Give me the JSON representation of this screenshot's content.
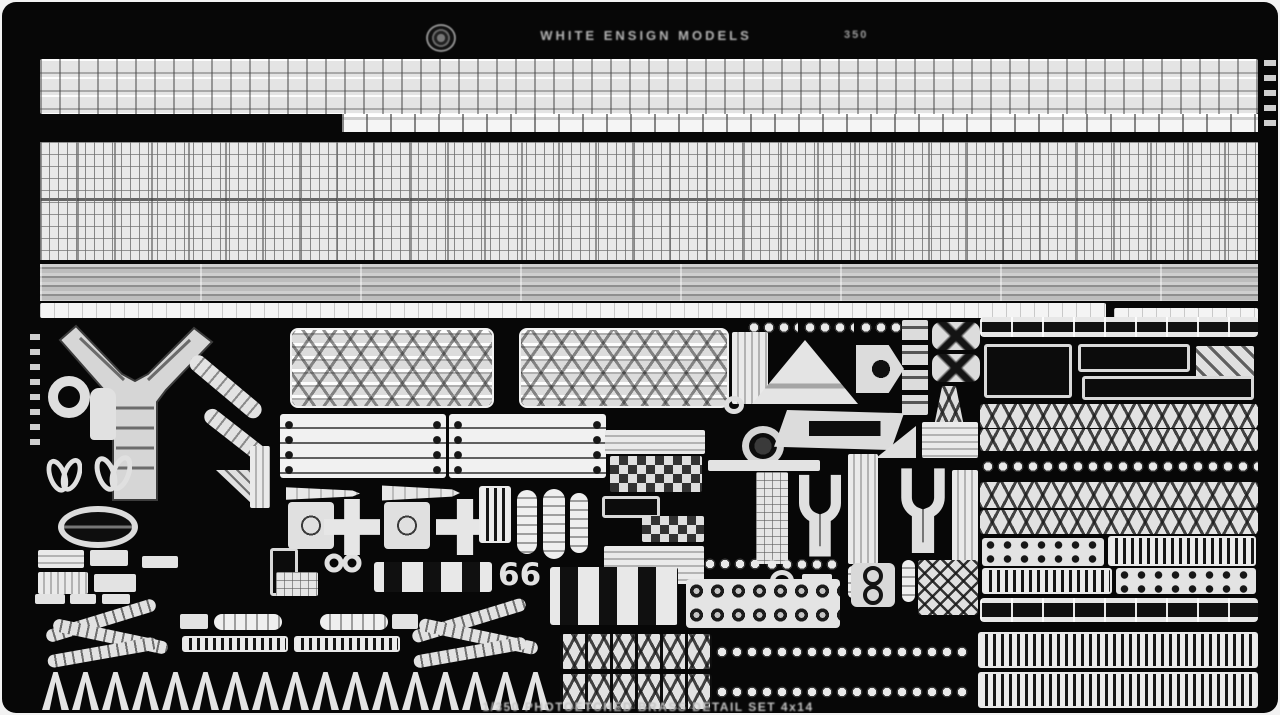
{
  "_legend": "parts fields: n=name, t=visual-type, x/y/w/h=pixel box, r=rotation-deg, c=glyph-text, cnt=repeat-count",
  "header": {
    "brand": "WHITE ENSIGN MODELS",
    "code": "350"
  },
  "footer": {
    "caption": "1/350 PHOTOETCHED BRASS DETAIL SET  4x14"
  },
  "colors": {
    "photo_bg": "#070707",
    "brass_light": "#e4e4e4",
    "brass_mid": "#b9b9b9",
    "brass_dark": "#8a8a8a",
    "caption_text": "#c4c4c4"
  },
  "parts": [
    {
      "n": "railing-stock-band",
      "t": "railing",
      "x": 38,
      "y": 57,
      "w": 1218,
      "h": 55
    },
    {
      "n": "railing-stock-extension",
      "t": "railing-thin",
      "x": 340,
      "y": 112,
      "w": 916,
      "h": 18
    },
    {
      "n": "mesh-grating-panel",
      "t": "mesh",
      "x": 38,
      "y": 140,
      "w": 1218,
      "h": 118
    },
    {
      "n": "inclined-ladder-band",
      "t": "ladders",
      "x": 38,
      "y": 262,
      "w": 1218,
      "h": 37
    },
    {
      "n": "accommodation-ladder-strip",
      "t": "strip-bright",
      "x": 38,
      "y": 301,
      "w": 1066,
      "h": 15
    },
    {
      "n": "accommodation-ladder-strip-right",
      "t": "strip-bright",
      "x": 1112,
      "y": 306,
      "w": 144,
      "h": 14
    },
    {
      "n": "edge-marks-left",
      "t": "edge-marks",
      "x": 28,
      "y": 332,
      "w": 10,
      "h": 120
    },
    {
      "n": "crane-y-frame",
      "t": "yframe",
      "x": 52,
      "y": 322,
      "w": 162,
      "h": 180
    },
    {
      "n": "large-ring",
      "t": "ring",
      "x": 46,
      "y": 374,
      "w": 42,
      "h": 42
    },
    {
      "n": "bottle-part",
      "t": "bottle",
      "x": 88,
      "y": 386,
      "w": 26,
      "h": 52
    },
    {
      "n": "lattice-arm-upper",
      "t": "diagbar",
      "x": 190,
      "y": 348,
      "w": 88,
      "h": 17,
      "r": 40
    },
    {
      "n": "lattice-arm-lower",
      "t": "diagbar",
      "x": 204,
      "y": 402,
      "w": 74,
      "h": 16,
      "r": 38
    },
    {
      "n": "leaf-pair-1",
      "t": "leaf",
      "x": 44,
      "y": 447,
      "w": 36,
      "h": 46
    },
    {
      "n": "leaf-pair-2",
      "t": "leaf",
      "x": 92,
      "y": 444,
      "w": 38,
      "h": 48
    },
    {
      "n": "oval-boat-part",
      "t": "oval",
      "x": 56,
      "y": 504,
      "w": 80,
      "h": 42
    },
    {
      "n": "plate-a",
      "t": "tex-h",
      "x": 36,
      "y": 548,
      "w": 46,
      "h": 18
    },
    {
      "n": "plate-b",
      "t": "solid",
      "x": 88,
      "y": 548,
      "w": 38,
      "h": 16
    },
    {
      "n": "plate-c",
      "t": "tex-v",
      "x": 36,
      "y": 570,
      "w": 50,
      "h": 22
    },
    {
      "n": "plate-d",
      "t": "solid",
      "x": 92,
      "y": 572,
      "w": 42,
      "h": 18
    },
    {
      "n": "small-bar",
      "t": "solid",
      "x": 140,
      "y": 554,
      "w": 36,
      "h": 12
    },
    {
      "n": "tri-hatch-plate",
      "t": "tri-diag",
      "x": 214,
      "y": 468,
      "w": 36,
      "h": 34
    },
    {
      "n": "tall-plate",
      "t": "tex-v",
      "x": 248,
      "y": 444,
      "w": 20,
      "h": 62
    },
    {
      "n": "frame-column",
      "t": "outline",
      "x": 268,
      "y": 546,
      "w": 28,
      "h": 48
    },
    {
      "n": "ring-pair",
      "t": "rings2",
      "x": 322,
      "y": 550,
      "w": 38,
      "h": 22
    },
    {
      "n": "mini-grid-plate",
      "t": "tex-grid",
      "x": 274,
      "y": 570,
      "w": 42,
      "h": 24
    },
    {
      "n": "lattice-boom-1",
      "t": "boom",
      "x": 288,
      "y": 326,
      "w": 204,
      "h": 80
    },
    {
      "n": "lattice-boom-2",
      "t": "boom",
      "x": 517,
      "y": 326,
      "w": 210,
      "h": 80
    },
    {
      "n": "boom-end-fittings",
      "t": "tex-v",
      "x": 730,
      "y": 330,
      "w": 36,
      "h": 72
    },
    {
      "n": "boat-chock-panel-1",
      "t": "lined-panel",
      "x": 278,
      "y": 412,
      "w": 166,
      "h": 64
    },
    {
      "n": "boat-chock-panel-2",
      "t": "lined-panel",
      "x": 447,
      "y": 412,
      "w": 157,
      "h": 64
    },
    {
      "n": "tapered-strip-1",
      "t": "taper-right",
      "x": 284,
      "y": 484,
      "w": 74,
      "h": 15
    },
    {
      "n": "tapered-strip-2",
      "t": "taper-right",
      "x": 380,
      "y": 482,
      "w": 78,
      "h": 18
    },
    {
      "n": "plate-with-circle-1",
      "t": "plate-circle",
      "x": 286,
      "y": 500,
      "w": 46,
      "h": 47
    },
    {
      "n": "cross-brace-1",
      "t": "cross",
      "x": 322,
      "y": 497,
      "w": 56,
      "h": 56
    },
    {
      "n": "plate-with-circle-2",
      "t": "plate-circle",
      "x": 382,
      "y": 500,
      "w": 46,
      "h": 47
    },
    {
      "n": "cross-brace-2",
      "t": "cross",
      "x": 434,
      "y": 497,
      "w": 58,
      "h": 56
    },
    {
      "n": "vertical-grate",
      "t": "slat",
      "x": 477,
      "y": 484,
      "w": 32,
      "h": 57
    },
    {
      "n": "capsule-part-1",
      "t": "capsule",
      "x": 515,
      "y": 488,
      "w": 20,
      "h": 64
    },
    {
      "n": "capsule-part-2",
      "t": "capsule",
      "x": 541,
      "y": 487,
      "w": 22,
      "h": 70
    },
    {
      "n": "capsule-part-3",
      "t": "capsule",
      "x": 568,
      "y": 491,
      "w": 18,
      "h": 60
    },
    {
      "n": "window-frame-row",
      "t": "slots",
      "x": 372,
      "y": 560,
      "w": 118,
      "h": 30
    },
    {
      "n": "hook-pair",
      "t": "glyph",
      "x": 496,
      "y": 558,
      "w": 40,
      "h": 34,
      "c": "66"
    },
    {
      "n": "checker-bar",
      "t": "tex-h",
      "x": 603,
      "y": 428,
      "w": 100,
      "h": 24
    },
    {
      "n": "checker-plate-1",
      "t": "checker",
      "x": 608,
      "y": 454,
      "w": 92,
      "h": 36
    },
    {
      "n": "step-plate",
      "t": "outline",
      "x": 600,
      "y": 494,
      "w": 58,
      "h": 22
    },
    {
      "n": "checker-plate-2",
      "t": "checker",
      "x": 640,
      "y": 514,
      "w": 62,
      "h": 26
    },
    {
      "n": "lined-plate-left",
      "t": "tex-h",
      "x": 602,
      "y": 544,
      "w": 100,
      "h": 38
    },
    {
      "n": "chain-segment-1",
      "t": "chain",
      "x": 744,
      "y": 318,
      "w": 52,
      "h": 15
    },
    {
      "n": "chain-segment-2",
      "t": "chain",
      "x": 800,
      "y": 318,
      "w": 52,
      "h": 15
    },
    {
      "n": "chain-segment-3",
      "t": "chain",
      "x": 856,
      "y": 318,
      "w": 62,
      "h": 15
    },
    {
      "n": "triangle-platform",
      "t": "triangle",
      "x": 750,
      "y": 338,
      "w": 106,
      "h": 64
    },
    {
      "n": "small-ring-1",
      "t": "ring-thin",
      "x": 722,
      "y": 394,
      "w": 20,
      "h": 18
    },
    {
      "n": "pentagon-plate",
      "t": "pent",
      "x": 854,
      "y": 343,
      "w": 48,
      "h": 48
    },
    {
      "n": "square-stack",
      "t": "stack4",
      "x": 900,
      "y": 318,
      "w": 26,
      "h": 95
    },
    {
      "n": "x-box-1",
      "t": "xbox",
      "x": 930,
      "y": 320,
      "w": 48,
      "h": 28
    },
    {
      "n": "x-box-2",
      "t": "xbox",
      "x": 930,
      "y": 352,
      "w": 48,
      "h": 28
    },
    {
      "n": "lattice-tower",
      "t": "tower",
      "x": 928,
      "y": 384,
      "w": 38,
      "h": 60
    },
    {
      "n": "dark-ring-part",
      "t": "ring-dark",
      "x": 740,
      "y": 424,
      "w": 42,
      "h": 40
    },
    {
      "n": "trapezoid-plate",
      "t": "trap-slot",
      "x": 772,
      "y": 408,
      "w": 130,
      "h": 40
    },
    {
      "n": "bright-bar",
      "t": "solid",
      "x": 706,
      "y": 458,
      "w": 112,
      "h": 11
    },
    {
      "n": "right-triangle-plate",
      "t": "rtriangle",
      "x": 874,
      "y": 424,
      "w": 40,
      "h": 32
    },
    {
      "n": "lined-plate-right",
      "t": "tex-h",
      "x": 920,
      "y": 420,
      "w": 56,
      "h": 36
    },
    {
      "n": "tall-plate-1",
      "t": "tex-grid",
      "x": 754,
      "y": 470,
      "w": 32,
      "h": 92
    },
    {
      "n": "yoke-part-1",
      "t": "yoke",
      "x": 790,
      "y": 466,
      "w": 56,
      "h": 94
    },
    {
      "n": "tall-plate-2",
      "t": "tex-v",
      "x": 846,
      "y": 452,
      "w": 30,
      "h": 110
    },
    {
      "n": "yoke-part-2",
      "t": "yoke",
      "x": 892,
      "y": 458,
      "w": 58,
      "h": 100
    },
    {
      "n": "tall-plate-3",
      "t": "tex-v",
      "x": 950,
      "y": 468,
      "w": 26,
      "h": 92
    },
    {
      "n": "small-ring-2",
      "t": "ring-thin",
      "x": 768,
      "y": 568,
      "w": 24,
      "h": 22
    },
    {
      "n": "small-plate",
      "t": "solid",
      "x": 800,
      "y": 572,
      "w": 30,
      "h": 16
    },
    {
      "n": "pin-1",
      "t": "capsule",
      "x": 846,
      "y": 564,
      "w": 9,
      "h": 32
    },
    {
      "n": "pin-2",
      "t": "capsule",
      "x": 860,
      "y": 564,
      "w": 9,
      "h": 32
    },
    {
      "n": "slotted-panel",
      "t": "slots",
      "x": 548,
      "y": 565,
      "w": 128,
      "h": 58
    },
    {
      "n": "link-bar",
      "t": "chain",
      "x": 700,
      "y": 556,
      "w": 58,
      "h": 12
    },
    {
      "n": "diamond-bar",
      "t": "chain",
      "x": 762,
      "y": 556,
      "w": 76,
      "h": 13
    },
    {
      "n": "ring-grid-panel",
      "t": "c-grid",
      "x": 684,
      "y": 577,
      "w": 154,
      "h": 49
    },
    {
      "n": "double-ring-plate",
      "t": "rings2v",
      "x": 848,
      "y": 560,
      "w": 46,
      "h": 46
    },
    {
      "n": "pin-3",
      "t": "capsule",
      "x": 900,
      "y": 558,
      "w": 13,
      "h": 42
    },
    {
      "n": "diamond-lattice-square",
      "t": "diag-grid",
      "x": 916,
      "y": 558,
      "w": 60,
      "h": 55
    },
    {
      "n": "truss-chain-strip-1a",
      "t": "xlat-boxes",
      "x": 558,
      "y": 632,
      "w": 152,
      "h": 35
    },
    {
      "n": "truss-chain-strip-1b",
      "t": "chain",
      "x": 712,
      "y": 638,
      "w": 254,
      "h": 24
    },
    {
      "n": "truss-chain-strip-2a",
      "t": "xlat-boxes",
      "x": 558,
      "y": 672,
      "w": 152,
      "h": 35
    },
    {
      "n": "truss-chain-strip-2b",
      "t": "chain",
      "x": 712,
      "y": 678,
      "w": 254,
      "h": 24
    },
    {
      "n": "tab-1",
      "t": "solid",
      "x": 33,
      "y": 592,
      "w": 30,
      "h": 10
    },
    {
      "n": "tab-2",
      "t": "solid",
      "x": 68,
      "y": 592,
      "w": 26,
      "h": 10
    },
    {
      "n": "tab-3",
      "t": "solid",
      "x": 100,
      "y": 592,
      "w": 28,
      "h": 10
    },
    {
      "n": "lattice-cluster-1",
      "t": "zig",
      "x": 42,
      "y": 604,
      "w": 130,
      "h": 62
    },
    {
      "n": "barrel-1",
      "t": "capsule-h",
      "x": 212,
      "y": 612,
      "w": 68,
      "h": 16
    },
    {
      "n": "barrel-mount-1",
      "t": "solid",
      "x": 178,
      "y": 612,
      "w": 28,
      "h": 15
    },
    {
      "n": "barrel-base-1",
      "t": "slat",
      "x": 180,
      "y": 634,
      "w": 106,
      "h": 16
    },
    {
      "n": "barrel-2",
      "t": "capsule-h",
      "x": 318,
      "y": 612,
      "w": 68,
      "h": 16
    },
    {
      "n": "barrel-mount-2",
      "t": "solid",
      "x": 390,
      "y": 612,
      "w": 26,
      "h": 15
    },
    {
      "n": "barrel-base-2",
      "t": "slat",
      "x": 292,
      "y": 634,
      "w": 106,
      "h": 16
    },
    {
      "n": "lattice-cluster-2",
      "t": "zig",
      "x": 408,
      "y": 604,
      "w": 134,
      "h": 64
    },
    {
      "n": "davit-a-frame-row",
      "t": "arow",
      "x": 40,
      "y": 670,
      "w": 506,
      "h": 38,
      "cnt": 17
    },
    {
      "n": "segment-bar",
      "t": "rail-bar",
      "x": 978,
      "y": 315,
      "w": 278,
      "h": 20
    },
    {
      "n": "step-plate-1",
      "t": "outline",
      "x": 982,
      "y": 342,
      "w": 88,
      "h": 54
    },
    {
      "n": "step-plate-2",
      "t": "outline",
      "x": 1076,
      "y": 342,
      "w": 112,
      "h": 28
    },
    {
      "n": "hatch-plate",
      "t": "tex-diag",
      "x": 1194,
      "y": 344,
      "w": 58,
      "h": 40
    },
    {
      "n": "taper-plate",
      "t": "outline",
      "x": 1080,
      "y": 374,
      "w": 172,
      "h": 24
    },
    {
      "n": "truss-strip-1",
      "t": "xlat",
      "x": 978,
      "y": 402,
      "w": 278,
      "h": 24
    },
    {
      "n": "truss-strip-2",
      "t": "xlat",
      "x": 978,
      "y": 427,
      "w": 278,
      "h": 22
    },
    {
      "n": "oval-chain-strip",
      "t": "chain",
      "x": 978,
      "y": 452,
      "w": 278,
      "h": 25
    },
    {
      "n": "truss-strip-3",
      "t": "xlat",
      "x": 978,
      "y": 480,
      "w": 278,
      "h": 26
    },
    {
      "n": "truss-strip-4",
      "t": "xlat",
      "x": 978,
      "y": 508,
      "w": 278,
      "h": 24
    },
    {
      "n": "dot-plate-1",
      "t": "dots",
      "x": 980,
      "y": 536,
      "w": 122,
      "h": 28
    },
    {
      "n": "slat-plate-1",
      "t": "slat",
      "x": 1106,
      "y": 534,
      "w": 148,
      "h": 30
    },
    {
      "n": "slat-plate-2",
      "t": "slat",
      "x": 980,
      "y": 566,
      "w": 130,
      "h": 26
    },
    {
      "n": "dot-plate-2",
      "t": "dots",
      "x": 1114,
      "y": 566,
      "w": 140,
      "h": 26
    },
    {
      "n": "edge-bar",
      "t": "rail-bar",
      "x": 978,
      "y": 596,
      "w": 278,
      "h": 24
    },
    {
      "n": "grate-strip-1",
      "t": "slat",
      "x": 976,
      "y": 630,
      "w": 280,
      "h": 36
    },
    {
      "n": "grate-strip-2",
      "t": "slat",
      "x": 976,
      "y": 670,
      "w": 280,
      "h": 36
    },
    {
      "n": "edge-marks-right",
      "t": "edge-marks",
      "x": 1262,
      "y": 58,
      "w": 12,
      "h": 72
    }
  ]
}
